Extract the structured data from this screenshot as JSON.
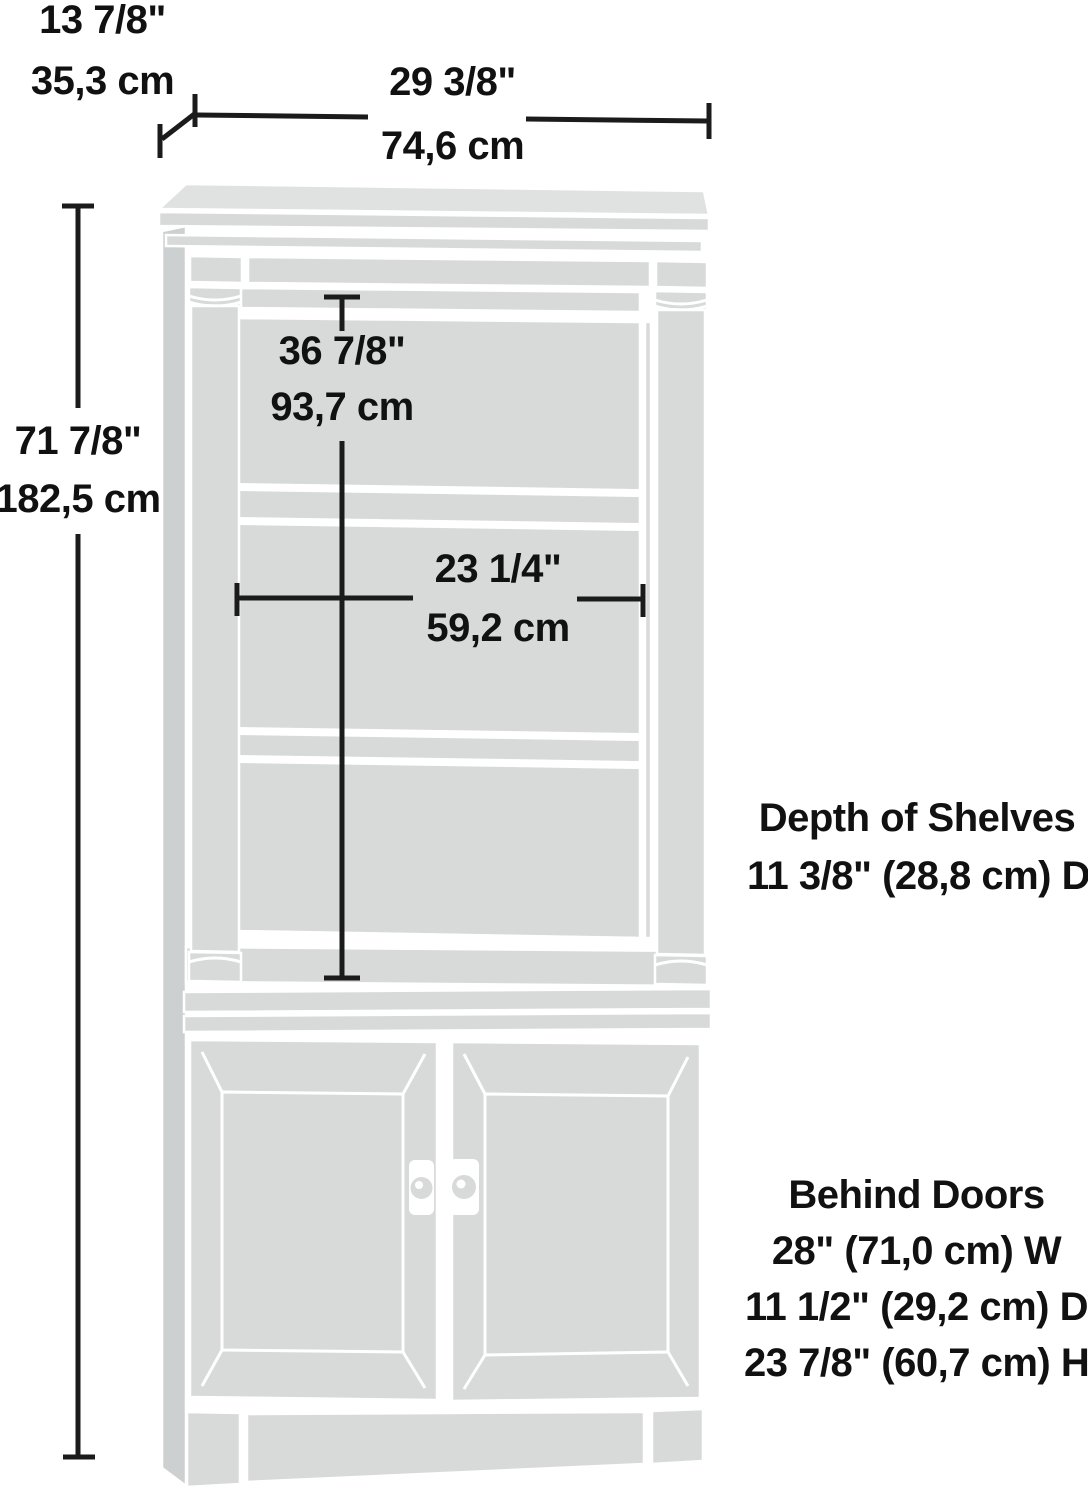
{
  "diagram": {
    "product": "bookcase-with-doors-dimension-diagram",
    "overall": {
      "depth_in": "13 7/8\"",
      "depth_cm": "35,3 cm",
      "width_in": "29 3/8\"",
      "width_cm": "74,6 cm",
      "height_in": "71 7/8\"",
      "height_cm": "182,5 cm"
    },
    "interior": {
      "height_in": "36 7/8\"",
      "height_cm": "93,7 cm",
      "width_in": "23 1/4\"",
      "width_cm": "59,2 cm"
    },
    "notes": {
      "shelves_title": "Depth of Shelves",
      "shelves_value": "11 3/8\" (28,8 cm) D",
      "doors_title": "Behind Doors",
      "doors_width": "28\" (71,0 cm) W",
      "doors_depth": "11 1/2\" (29,2 cm) D",
      "doors_height": "23 7/8\" (60,7 cm) H"
    },
    "colors": {
      "cabinet_fill": "#d8dada",
      "cabinet_top": "#e0e2e2",
      "cabinet_side": "#cdd0d0",
      "dimension_line": "#1b1b1b",
      "text": "#111111",
      "background": "#ffffff"
    }
  }
}
